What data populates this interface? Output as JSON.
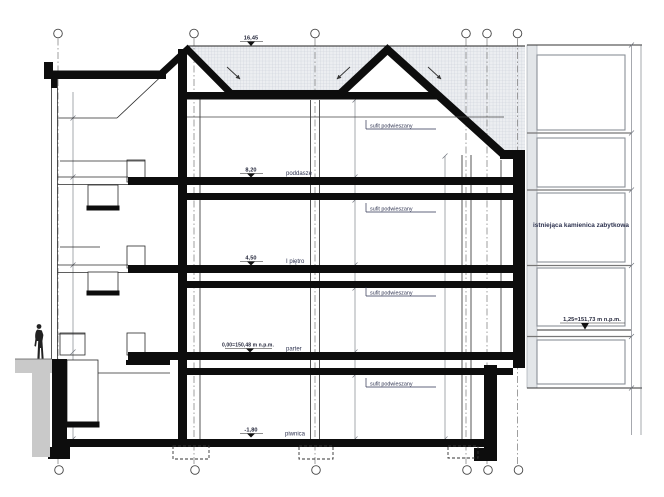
{
  "drawing": {
    "type": "architectural-cross-section",
    "levels": {
      "ridge": {
        "value": "16,45"
      },
      "poddasze": {
        "value": "8,20",
        "label": "poddasze"
      },
      "pietro": {
        "value": "4,50",
        "label": "I piętro"
      },
      "parter": {
        "value": "0,00=150,48 m n.p.m.",
        "label": "parter"
      },
      "piwnica": {
        "value": "-1,80",
        "label": "piwnica"
      }
    },
    "annotations": {
      "ceiling_label": "sufit podwieszany",
      "neighbor_label": "istniejąca kamienica zabytkowa",
      "neighbor_level": "1,25=151,73 m n.p.m."
    },
    "colors": {
      "ink": "#111111",
      "roof_hatch": "#e9ebee",
      "retaining_gray": "#c9c9c9"
    }
  }
}
